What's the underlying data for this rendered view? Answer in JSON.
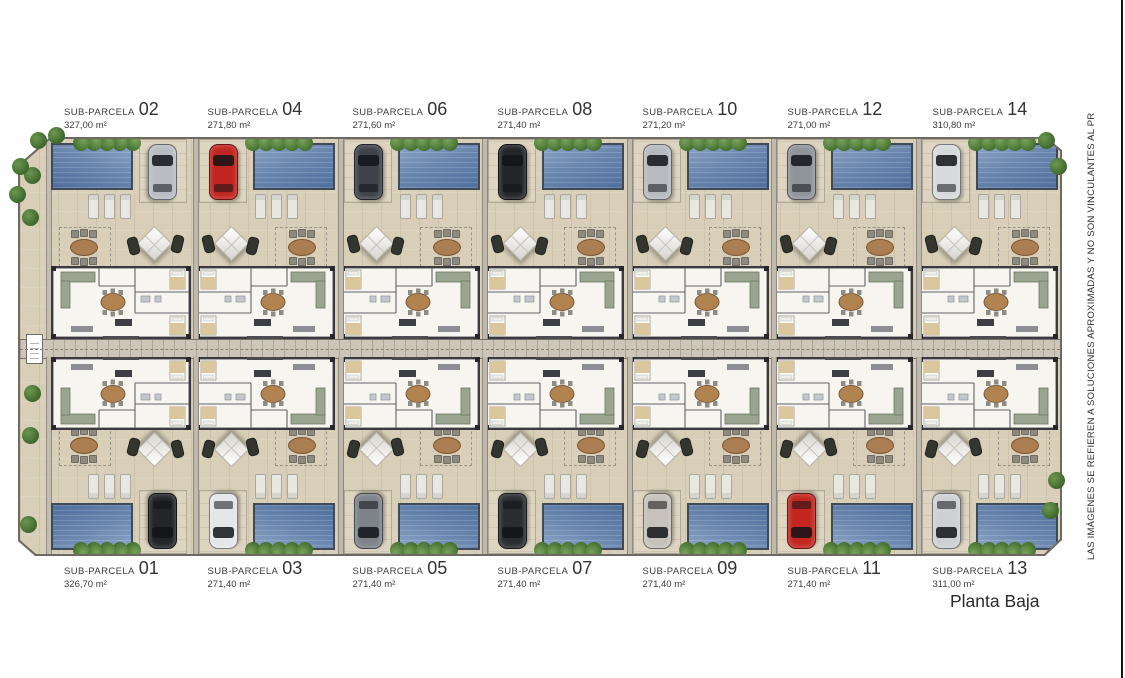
{
  "disclaimer": "LAS IMÁGENES SE REFIEREN A SOLUCIONES APROXIMADAS Y NO SON VINCULANTES AL PR",
  "plan_title": "Planta Baja",
  "parcel_label": "SUB-PARCELA",
  "colors": {
    "pool": "#5a769f",
    "ground": "#d9cfb8",
    "hedge": "#4c7a36",
    "corridor": "#cdc6b8"
  },
  "top_row": [
    {
      "number": "02",
      "area": "327,00 m²",
      "car_color": "#b9bdc3",
      "pool_side": "left"
    },
    {
      "number": "04",
      "area": "271,80 m²",
      "car_color": "#c1251f",
      "pool_side": "right"
    },
    {
      "number": "06",
      "area": "271,60 m²",
      "car_color": "#3f424a",
      "pool_side": "right"
    },
    {
      "number": "08",
      "area": "271,40 m²",
      "car_color": "#232529",
      "pool_side": "right"
    },
    {
      "number": "10",
      "area": "271,20 m²",
      "car_color": "#b7bbc1",
      "pool_side": "right"
    },
    {
      "number": "12",
      "area": "271,00 m²",
      "car_color": "#8f949b",
      "pool_side": "right"
    },
    {
      "number": "14",
      "area": "310,80 m²",
      "car_color": "#d7d9db",
      "pool_side": "right"
    }
  ],
  "bottom_row": [
    {
      "number": "01",
      "area": "326,70 m²",
      "car_color": "#232529",
      "pool_side": "left"
    },
    {
      "number": "03",
      "area": "271,40 m²",
      "car_color": "#e4e6e8",
      "pool_side": "right"
    },
    {
      "number": "05",
      "area": "271,40 m²",
      "car_color": "#7e838a",
      "pool_side": "right"
    },
    {
      "number": "07",
      "area": "271,40 m²",
      "car_color": "#2a2c30",
      "pool_side": "right"
    },
    {
      "number": "09",
      "area": "271,40 m²",
      "car_color": "#c6c1bb",
      "pool_side": "right"
    },
    {
      "number": "11",
      "area": "271,40 m²",
      "car_color": "#c2261f",
      "pool_side": "right"
    },
    {
      "number": "13",
      "area": "311,00 m²",
      "car_color": "#ced1d4",
      "pool_side": "right"
    }
  ]
}
